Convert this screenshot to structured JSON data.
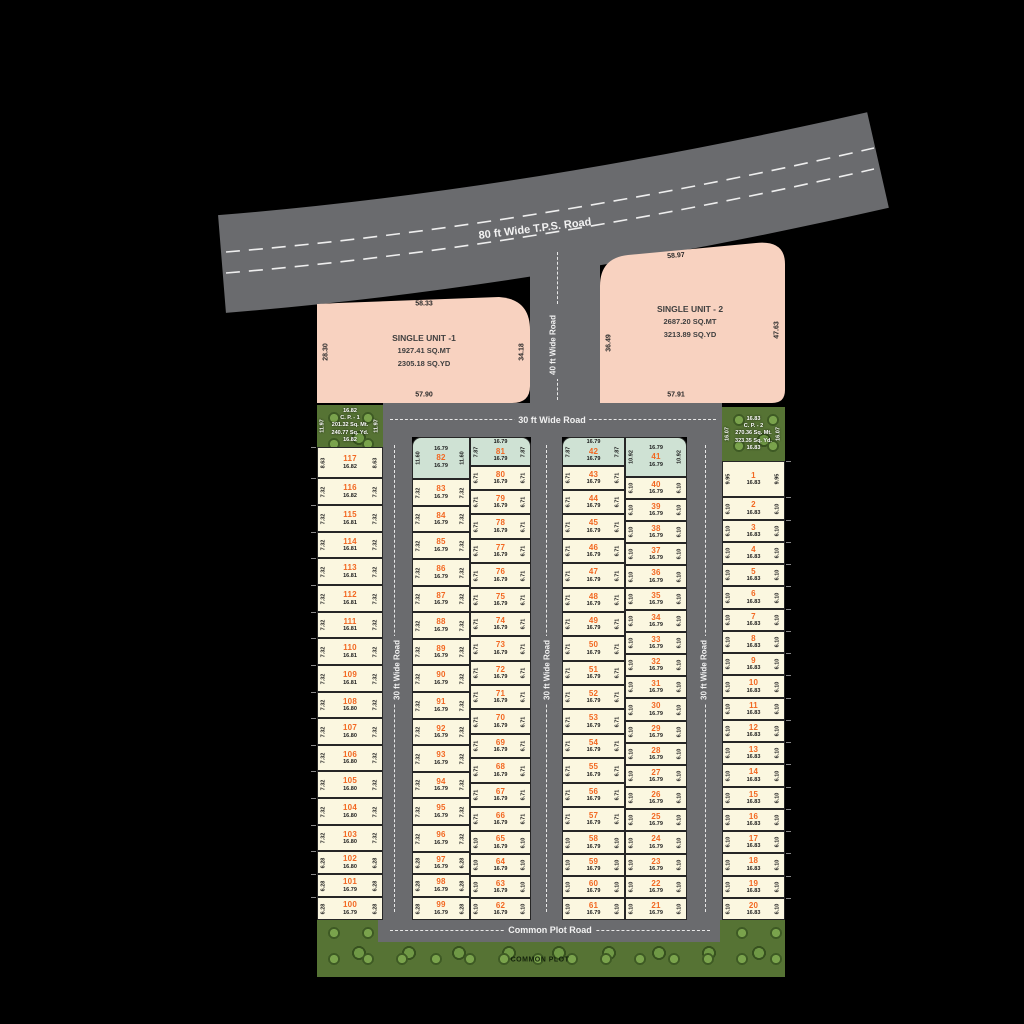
{
  "roads": {
    "tps": "80 ft Wide T.P.S. Road",
    "forty": "40 ft Wide Road",
    "cross": "30 ft Wide Road",
    "street1": "30 ft Wide Road",
    "street2": "30 ft Wide Road",
    "street3": "30 ft Wide Road",
    "bottom": "Common Plot Road"
  },
  "common_plot_label": "COMMON PLOT",
  "single_units": [
    {
      "name": "SINGLE UNIT -1",
      "area_mt": "1927.41 SQ.MT",
      "area_yd": "2305.18 SQ.YD",
      "dim_top": "58.33",
      "dim_left": "28.30",
      "dim_right": "34.18",
      "dim_bottom": "57.90"
    },
    {
      "name": "SINGLE UNIT - 2",
      "area_mt": "2687.20 SQ.MT",
      "area_yd": "3213.89 SQ.YD",
      "dim_top": "58.97",
      "dim_left": "36.49",
      "dim_right": "47.63",
      "dim_bottom": "57.91"
    }
  ],
  "common_plots": [
    {
      "dim_top": "16.82",
      "name": "C. P. - 1",
      "area_mt": "201.32 Sq. Mt.",
      "area_yd": "240.77 Sq. Yd.",
      "dim_bottom": "16.82",
      "dim_side": "11.97"
    },
    {
      "dim_top": "16.83",
      "name": "C. P. - 2",
      "area_mt": "270.36 Sq. Mt.",
      "area_yd": "323.35 Sq. Yd.",
      "dim_bottom": "16.83",
      "dim_side": "16.07"
    }
  ],
  "columns": [
    {
      "name": "plots-117-100",
      "plots": [
        [
          "117",
          "8.63",
          "16.82"
        ],
        [
          "116",
          "7.32",
          "16.82"
        ],
        [
          "115",
          "7.32",
          "16.81"
        ],
        [
          "114",
          "7.32",
          "16.81"
        ],
        [
          "113",
          "7.32",
          "16.81"
        ],
        [
          "112",
          "7.32",
          "16.81"
        ],
        [
          "111",
          "7.32",
          "16.81"
        ],
        [
          "110",
          "7.32",
          "16.81"
        ],
        [
          "109",
          "7.32",
          "16.81"
        ],
        [
          "108",
          "7.32",
          "16.80"
        ],
        [
          "107",
          "7.32",
          "16.80"
        ],
        [
          "106",
          "7.32",
          "16.80"
        ],
        [
          "105",
          "7.32",
          "16.80"
        ],
        [
          "104",
          "7.32",
          "16.80"
        ],
        [
          "103",
          "7.32",
          "16.80"
        ],
        [
          "102",
          "6.28",
          "16.80"
        ],
        [
          "101",
          "6.28",
          "16.79"
        ],
        [
          "100",
          "6.28",
          "16.79"
        ]
      ]
    },
    {
      "name": "plots-82-99",
      "plots": [
        [
          "82",
          "11.60",
          "16.79",
          "teal"
        ],
        [
          "83",
          "7.32",
          "16.79"
        ],
        [
          "84",
          "7.32",
          "16.79"
        ],
        [
          "85",
          "7.32",
          "16.79"
        ],
        [
          "86",
          "7.32",
          "16.79"
        ],
        [
          "87",
          "7.32",
          "16.79"
        ],
        [
          "88",
          "7.32",
          "16.79"
        ],
        [
          "89",
          "7.32",
          "16.79"
        ],
        [
          "90",
          "7.32",
          "16.79"
        ],
        [
          "91",
          "7.32",
          "16.79"
        ],
        [
          "92",
          "7.32",
          "16.79"
        ],
        [
          "93",
          "7.32",
          "16.79"
        ],
        [
          "94",
          "7.32",
          "16.79"
        ],
        [
          "95",
          "7.32",
          "16.79"
        ],
        [
          "96",
          "7.32",
          "16.79"
        ],
        [
          "97",
          "6.28",
          "16.79"
        ],
        [
          "98",
          "6.28",
          "16.79"
        ],
        [
          "99",
          "6.28",
          "16.79"
        ]
      ]
    },
    {
      "name": "plots-81-62",
      "plots": [
        [
          "81",
          "7.87",
          "16.79",
          "teal"
        ],
        [
          "80",
          "6.71",
          "16.79"
        ],
        [
          "79",
          "6.71",
          "16.79"
        ],
        [
          "78",
          "6.71",
          "16.79"
        ],
        [
          "77",
          "6.71",
          "16.79"
        ],
        [
          "76",
          "6.71",
          "16.79"
        ],
        [
          "75",
          "6.71",
          "16.79"
        ],
        [
          "74",
          "6.71",
          "16.79"
        ],
        [
          "73",
          "6.71",
          "16.79"
        ],
        [
          "72",
          "6.71",
          "16.79"
        ],
        [
          "71",
          "6.71",
          "16.79"
        ],
        [
          "70",
          "6.71",
          "16.79"
        ],
        [
          "69",
          "6.71",
          "16.79"
        ],
        [
          "68",
          "6.71",
          "16.79"
        ],
        [
          "67",
          "6.71",
          "16.79"
        ],
        [
          "66",
          "6.71",
          "16.79"
        ],
        [
          "65",
          "6.10",
          "16.79"
        ],
        [
          "64",
          "6.10",
          "16.79"
        ],
        [
          "63",
          "6.10",
          "16.79"
        ],
        [
          "62",
          "6.10",
          "16.79"
        ]
      ]
    },
    {
      "name": "plots-42-61",
      "plots": [
        [
          "42",
          "7.87",
          "16.79",
          "teal"
        ],
        [
          "43",
          "6.71",
          "16.79"
        ],
        [
          "44",
          "6.71",
          "16.79"
        ],
        [
          "45",
          "6.71",
          "16.79"
        ],
        [
          "46",
          "6.71",
          "16.79"
        ],
        [
          "47",
          "6.71",
          "16.79"
        ],
        [
          "48",
          "6.71",
          "16.79"
        ],
        [
          "49",
          "6.71",
          "16.79"
        ],
        [
          "50",
          "6.71",
          "16.79"
        ],
        [
          "51",
          "6.71",
          "16.79"
        ],
        [
          "52",
          "6.71",
          "16.79"
        ],
        [
          "53",
          "6.71",
          "16.79"
        ],
        [
          "54",
          "6.71",
          "16.79"
        ],
        [
          "55",
          "6.71",
          "16.79"
        ],
        [
          "56",
          "6.71",
          "16.79"
        ],
        [
          "57",
          "6.71",
          "16.79"
        ],
        [
          "58",
          "6.10",
          "16.79"
        ],
        [
          "59",
          "6.10",
          "16.79"
        ],
        [
          "60",
          "6.10",
          "16.79"
        ],
        [
          "61",
          "6.10",
          "16.79"
        ]
      ]
    },
    {
      "name": "plots-41-21",
      "plots": [
        [
          "41",
          "10.92",
          "16.79",
          "teal"
        ],
        [
          "40",
          "6.10",
          "16.79"
        ],
        [
          "39",
          "6.10",
          "16.79"
        ],
        [
          "38",
          "6.10",
          "16.79"
        ],
        [
          "37",
          "6.10",
          "16.79"
        ],
        [
          "36",
          "6.10",
          "16.79"
        ],
        [
          "35",
          "6.10",
          "16.79"
        ],
        [
          "34",
          "6.10",
          "16.79"
        ],
        [
          "33",
          "6.10",
          "16.79"
        ],
        [
          "32",
          "6.10",
          "16.79"
        ],
        [
          "31",
          "6.10",
          "16.79"
        ],
        [
          "30",
          "6.10",
          "16.79"
        ],
        [
          "29",
          "6.10",
          "16.79"
        ],
        [
          "28",
          "6.10",
          "16.79"
        ],
        [
          "27",
          "6.10",
          "16.79"
        ],
        [
          "26",
          "6.10",
          "16.79"
        ],
        [
          "25",
          "6.10",
          "16.79"
        ],
        [
          "24",
          "6.10",
          "16.79"
        ],
        [
          "23",
          "6.10",
          "16.79"
        ],
        [
          "22",
          "6.10",
          "16.79"
        ],
        [
          "21",
          "6.10",
          "16.79"
        ]
      ]
    },
    {
      "name": "plots-1-20",
      "plots": [
        [
          "1",
          "9.95",
          "16.83"
        ],
        [
          "2",
          "6.10",
          "16.83"
        ],
        [
          "3",
          "6.10",
          "16.83"
        ],
        [
          "4",
          "6.10",
          "16.83"
        ],
        [
          "5",
          "6.10",
          "16.83"
        ],
        [
          "6",
          "6.10",
          "16.83"
        ],
        [
          "7",
          "6.10",
          "16.83"
        ],
        [
          "8",
          "6.10",
          "16.83"
        ],
        [
          "9",
          "6.10",
          "16.83"
        ],
        [
          "10",
          "6.10",
          "16.83"
        ],
        [
          "11",
          "6.10",
          "16.83"
        ],
        [
          "12",
          "6.10",
          "16.83"
        ],
        [
          "13",
          "6.10",
          "16.83"
        ],
        [
          "14",
          "6.10",
          "16.83"
        ],
        [
          "15",
          "6.10",
          "16.83"
        ],
        [
          "16",
          "6.10",
          "16.83"
        ],
        [
          "17",
          "6.10",
          "16.83"
        ],
        [
          "18",
          "6.10",
          "16.83"
        ],
        [
          "19",
          "6.10",
          "16.83"
        ],
        [
          "20",
          "6.10",
          "16.83"
        ]
      ]
    }
  ],
  "colors": {
    "road": "#6a6b6e",
    "plot": "#fbf7e0",
    "teal_plot": "#cfe2d4",
    "unit_pink": "#f8d2c0",
    "grass": "#567334",
    "plot_number": "#f26822"
  }
}
